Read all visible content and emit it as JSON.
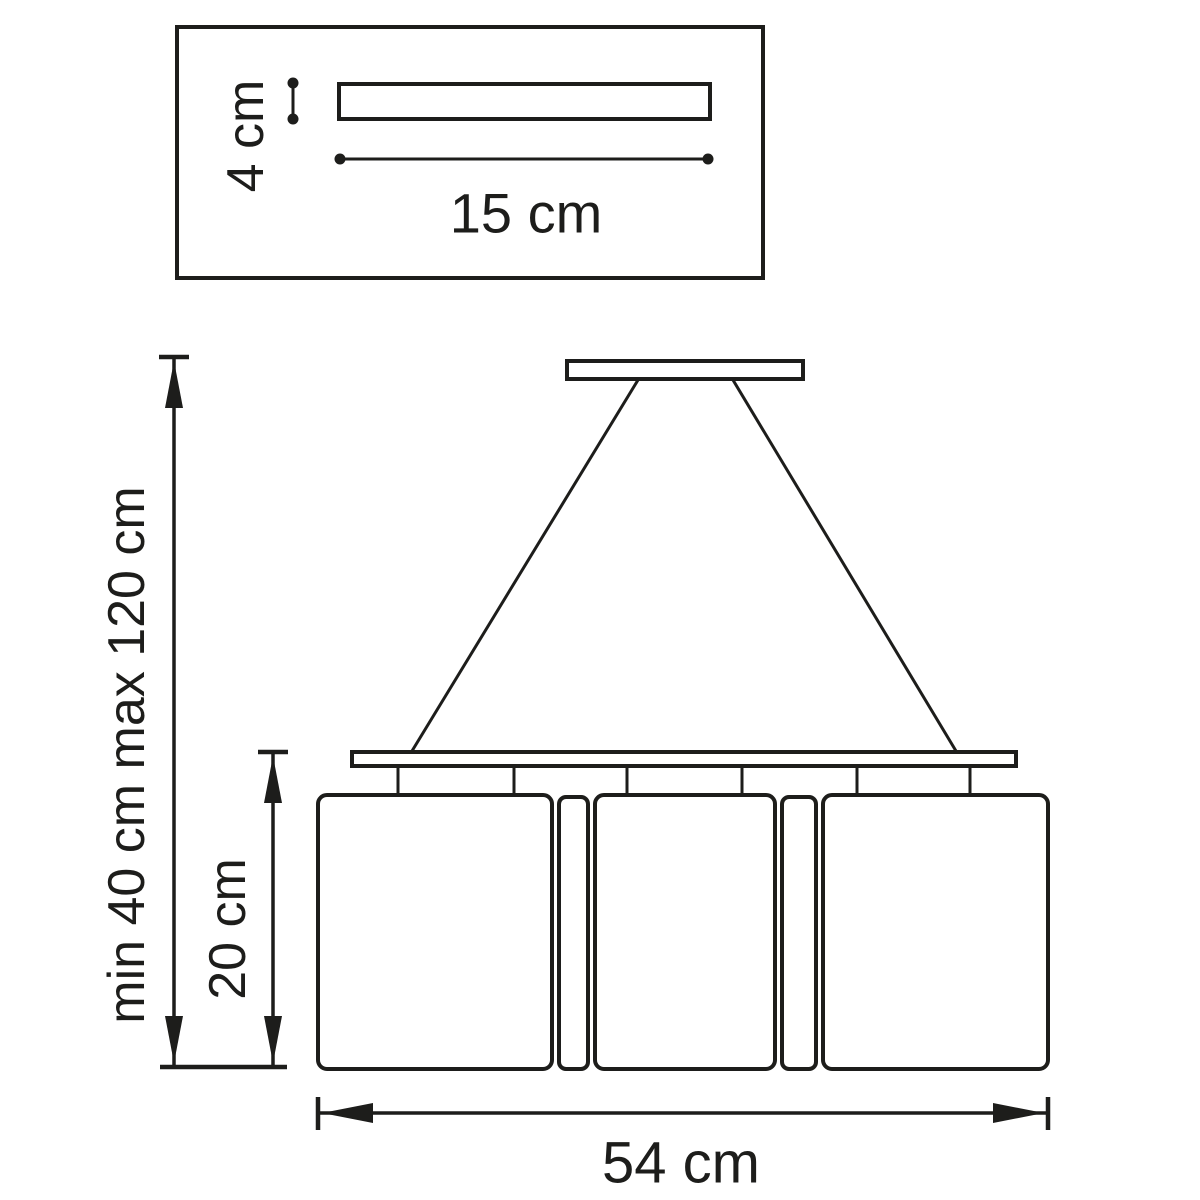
{
  "page": {
    "background": "#ffffff",
    "line_color": "#1d1d1b"
  },
  "canopy_detail": {
    "height_label": "4 cm",
    "width_label": "15 cm"
  },
  "fixture": {
    "suspension_label": "min 40 cm max 120 cm",
    "shade_height_label": "20 cm",
    "width_label": "54 cm"
  }
}
